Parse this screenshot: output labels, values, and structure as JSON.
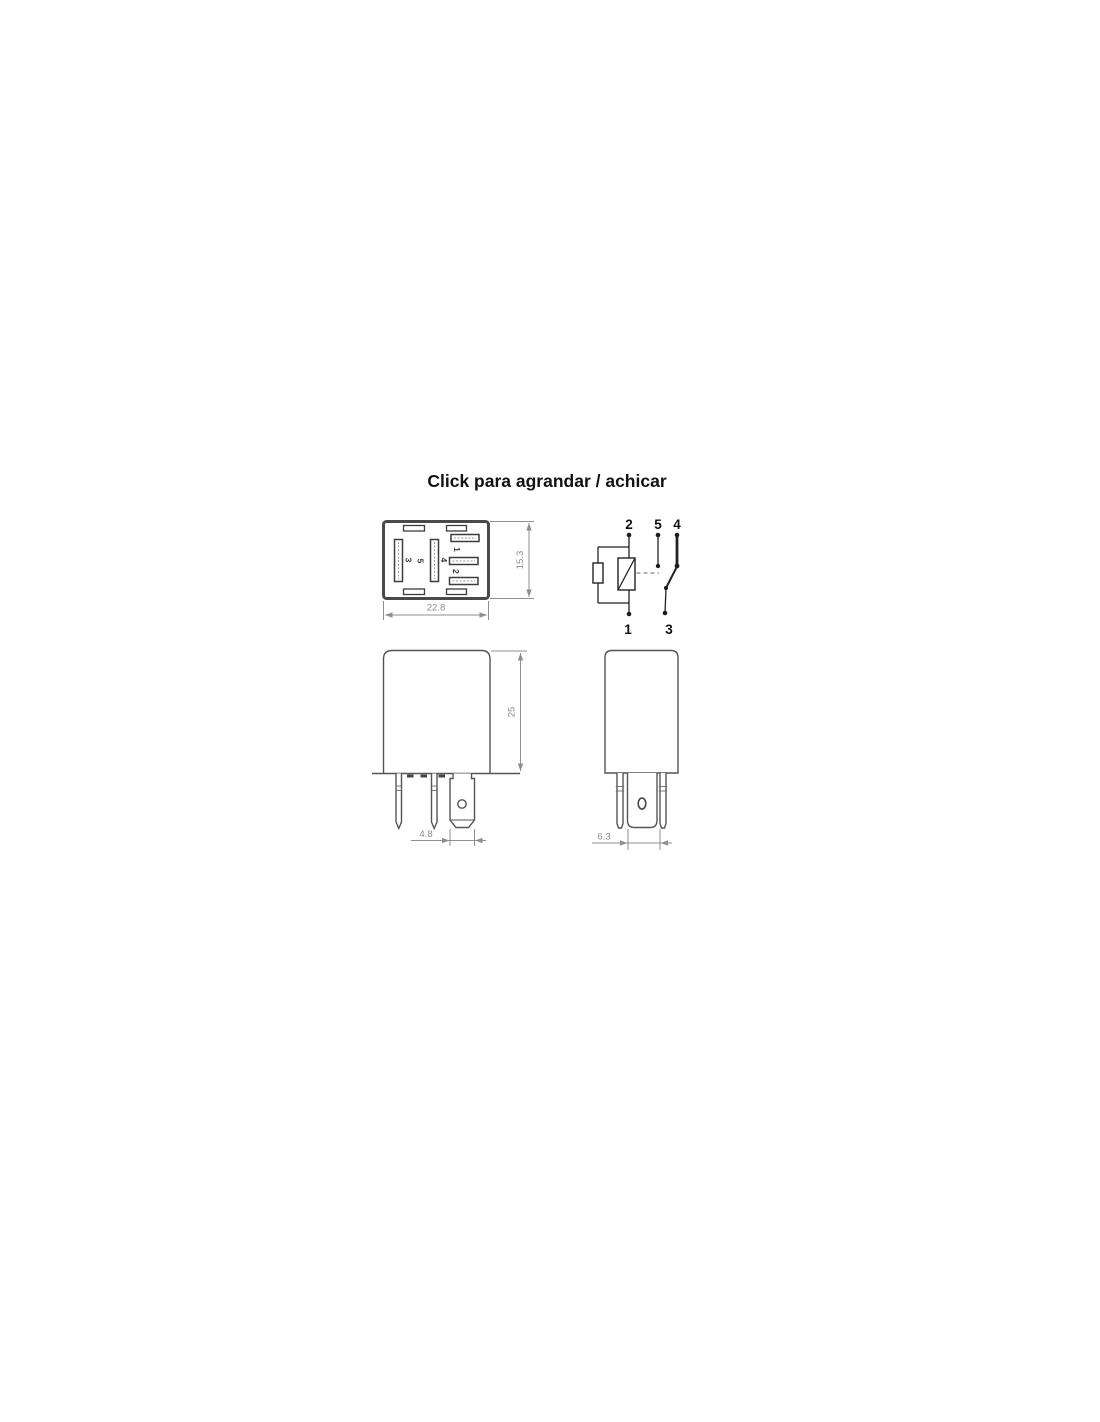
{
  "title": "Click para agrandar / achicar",
  "bottom_view": {
    "pin1": "1",
    "pin2": "2",
    "pin3": "3",
    "pin4": "4",
    "pin5": "5",
    "dim_width": "22.8",
    "dim_height": "15.3"
  },
  "schematic": {
    "pin1": "1",
    "pin2": "2",
    "pin3": "3",
    "pin4": "4",
    "pin5": "5"
  },
  "front_view": {
    "dim_height": "25",
    "dim_blade_width": "4.8"
  },
  "side_view": {
    "dim_pin_spacing": "6.3"
  },
  "colors": {
    "background": "#ffffff",
    "case_border": "#4a4a4a",
    "schematic_line": "#222222",
    "dimension_gray": "#8f8f8f",
    "title_text": "#121212"
  }
}
